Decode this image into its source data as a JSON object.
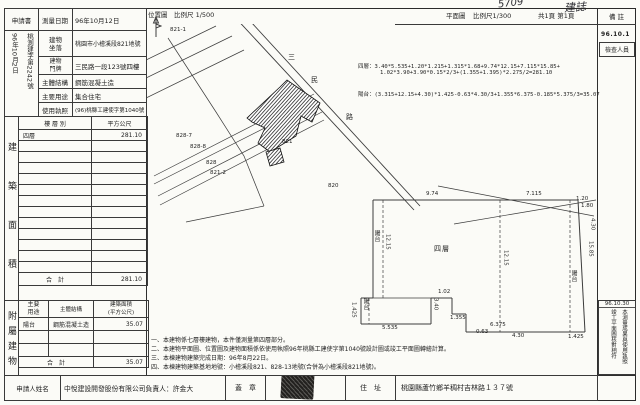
{
  "colors": {
    "ink": "#1f1f1f",
    "paper": "#fbfbf7"
  },
  "handwriting": {
    "mark1": "5709",
    "mark2": "建誌"
  },
  "form": {
    "application": "申請書",
    "survey_date_label": "測量日期",
    "survey_date": "96年10月12日",
    "receive_no": "桃測建字第2242號",
    "receive_date": "96年10月2日",
    "location_label": "建物\n坐落",
    "location": "桃園市小檜溪段821地號",
    "door_label": "建物\n門牌",
    "door": "三民路一段123號四樓",
    "structure_label": "主體結構",
    "structure": "鋼筋混凝土造",
    "use_label": "主要用途",
    "use": "集合住宅",
    "license_label": "使用執照",
    "license": "(96)桃縣工建使字第1040號"
  },
  "area_table": {
    "side": "建築面積",
    "col_floor": "樓 層 別",
    "col_area": "平方公尺",
    "floor": "四層",
    "floor_area": "281.10",
    "empty_rows": 12,
    "total_label": "合　計",
    "total": "281.10"
  },
  "annex_table": {
    "side": "附屬建物",
    "col_use": "主要\n用途",
    "col_struct": "主體結構",
    "col_area": "建築面積\n(平方公尺)",
    "use": "陽台",
    "struct": "鋼筋混凝土造",
    "area": "35.07",
    "empty_rows": 2,
    "total_label": "合　計",
    "total": "35.07"
  },
  "footer": {
    "applicant_label": "申請人姓名",
    "applicant": "中悅建設開發股份有限公司負責人：許金大",
    "seal_label": "蓋　章",
    "addr_label": "住　址",
    "addr": "桃園縣蘆竹鄉羊稠村吉林路１３７號"
  },
  "map": {
    "loc_title": "位置圖",
    "loc_scale": "比例尺 1/500",
    "plan_title": "平面圖",
    "plan_scale": "比例尺1/300",
    "pages": "共1頁 第1頁",
    "remark": "備 註",
    "remark_date": "96.10.1",
    "inspector": "檢查人員",
    "labels": [
      {
        "t": "三",
        "x": 142,
        "y": 46,
        "c": "road"
      },
      {
        "t": "民",
        "x": 165,
        "y": 69,
        "c": "road"
      },
      {
        "t": "路",
        "x": 200,
        "y": 106,
        "c": "road"
      },
      {
        "t": "821-1",
        "x": 24,
        "y": 20,
        "c": "parcel"
      },
      {
        "t": "828-7",
        "x": 30,
        "y": 126,
        "c": "parcel"
      },
      {
        "t": "828-8",
        "x": 44,
        "y": 137,
        "c": "parcel"
      },
      {
        "t": "828",
        "x": 60,
        "y": 153,
        "c": "parcel"
      },
      {
        "t": "821-2",
        "x": 64,
        "y": 163,
        "c": "parcel"
      },
      {
        "t": "821",
        "x": 136,
        "y": 132,
        "c": "parcel"
      },
      {
        "t": "820",
        "x": 182,
        "y": 176,
        "c": "parcel"
      },
      {
        "t": "9.74",
        "x": 280,
        "y": 184,
        "c": "dim"
      },
      {
        "t": "7.115",
        "x": 380,
        "y": 184,
        "c": "dim"
      },
      {
        "t": "1.20",
        "x": 430,
        "y": 189,
        "c": "dim"
      },
      {
        "t": "陽台",
        "x": 227,
        "y": 222,
        "c": "cjkv"
      },
      {
        "t": "12.15",
        "x": 238,
        "y": 226,
        "c": "dimv"
      },
      {
        "t": "四層",
        "x": 288,
        "y": 238,
        "c": "cjk"
      },
      {
        "t": "12.15",
        "x": 356,
        "y": 242,
        "c": "dimv"
      },
      {
        "t": "15.85",
        "x": 441,
        "y": 233,
        "c": "dimv"
      },
      {
        "t": "陽台",
        "x": 424,
        "y": 262,
        "c": "cjkv"
      },
      {
        "t": "1.425",
        "x": 422,
        "y": 327,
        "c": "dim"
      },
      {
        "t": "1.80",
        "x": 435,
        "y": 196,
        "c": "dim"
      },
      {
        "t": "4.30",
        "x": 443,
        "y": 210,
        "c": "dimv"
      },
      {
        "t": "陽台",
        "x": 216,
        "y": 290,
        "c": "cjkv"
      },
      {
        "t": "1.425",
        "x": 204,
        "y": 294,
        "c": "dimv"
      },
      {
        "t": "5.535",
        "x": 236,
        "y": 318,
        "c": "dim"
      },
      {
        "t": "3.40",
        "x": 286,
        "y": 290,
        "c": "dimv"
      },
      {
        "t": "1.02",
        "x": 292,
        "y": 282,
        "c": "dim"
      },
      {
        "t": "1.355",
        "x": 304,
        "y": 308,
        "c": "dim"
      },
      {
        "t": "0.63",
        "x": 330,
        "y": 322,
        "c": "dim"
      },
      {
        "t": "4.30",
        "x": 366,
        "y": 326,
        "c": "dim"
      },
      {
        "t": "6.375",
        "x": 344,
        "y": 315,
        "c": "dim"
      }
    ]
  },
  "formulas": {
    "f1": "四層：3.40*5.535+1.20*1.215+1.315*1.68+9.74*12.15+7.115*15.85+",
    "f2": "1.02*3.90+3.90*0.15*2/3+(1.355+1.395)*2.275/2=281.10",
    "f3": "陽台：(3.315+12.15+4.30)*1.425-0.63*4.30/3+1.355*6.375-0.185*5.375/3=35.07"
  },
  "notes": {
    "n1": "一、本建物係七層樓建物，本件僅測量第四層部分。",
    "n2": "二、本建物平面圖、位置圖及建物面積係依使用執照96年桃縣工建使字第1040號設計圖或竣工平面圖轉繪計算。",
    "n3": "三、本棟建物建築完成日期：96年8月22日。",
    "n4": "四、本棟建物建築基地地號：小檜溪段821、828-13地號(合併為小檜溪段821地號)。"
  },
  "stamp": {
    "date": "96.10.30",
    "text": "本測量成果與使用執照竣工平面圖核對相符"
  }
}
